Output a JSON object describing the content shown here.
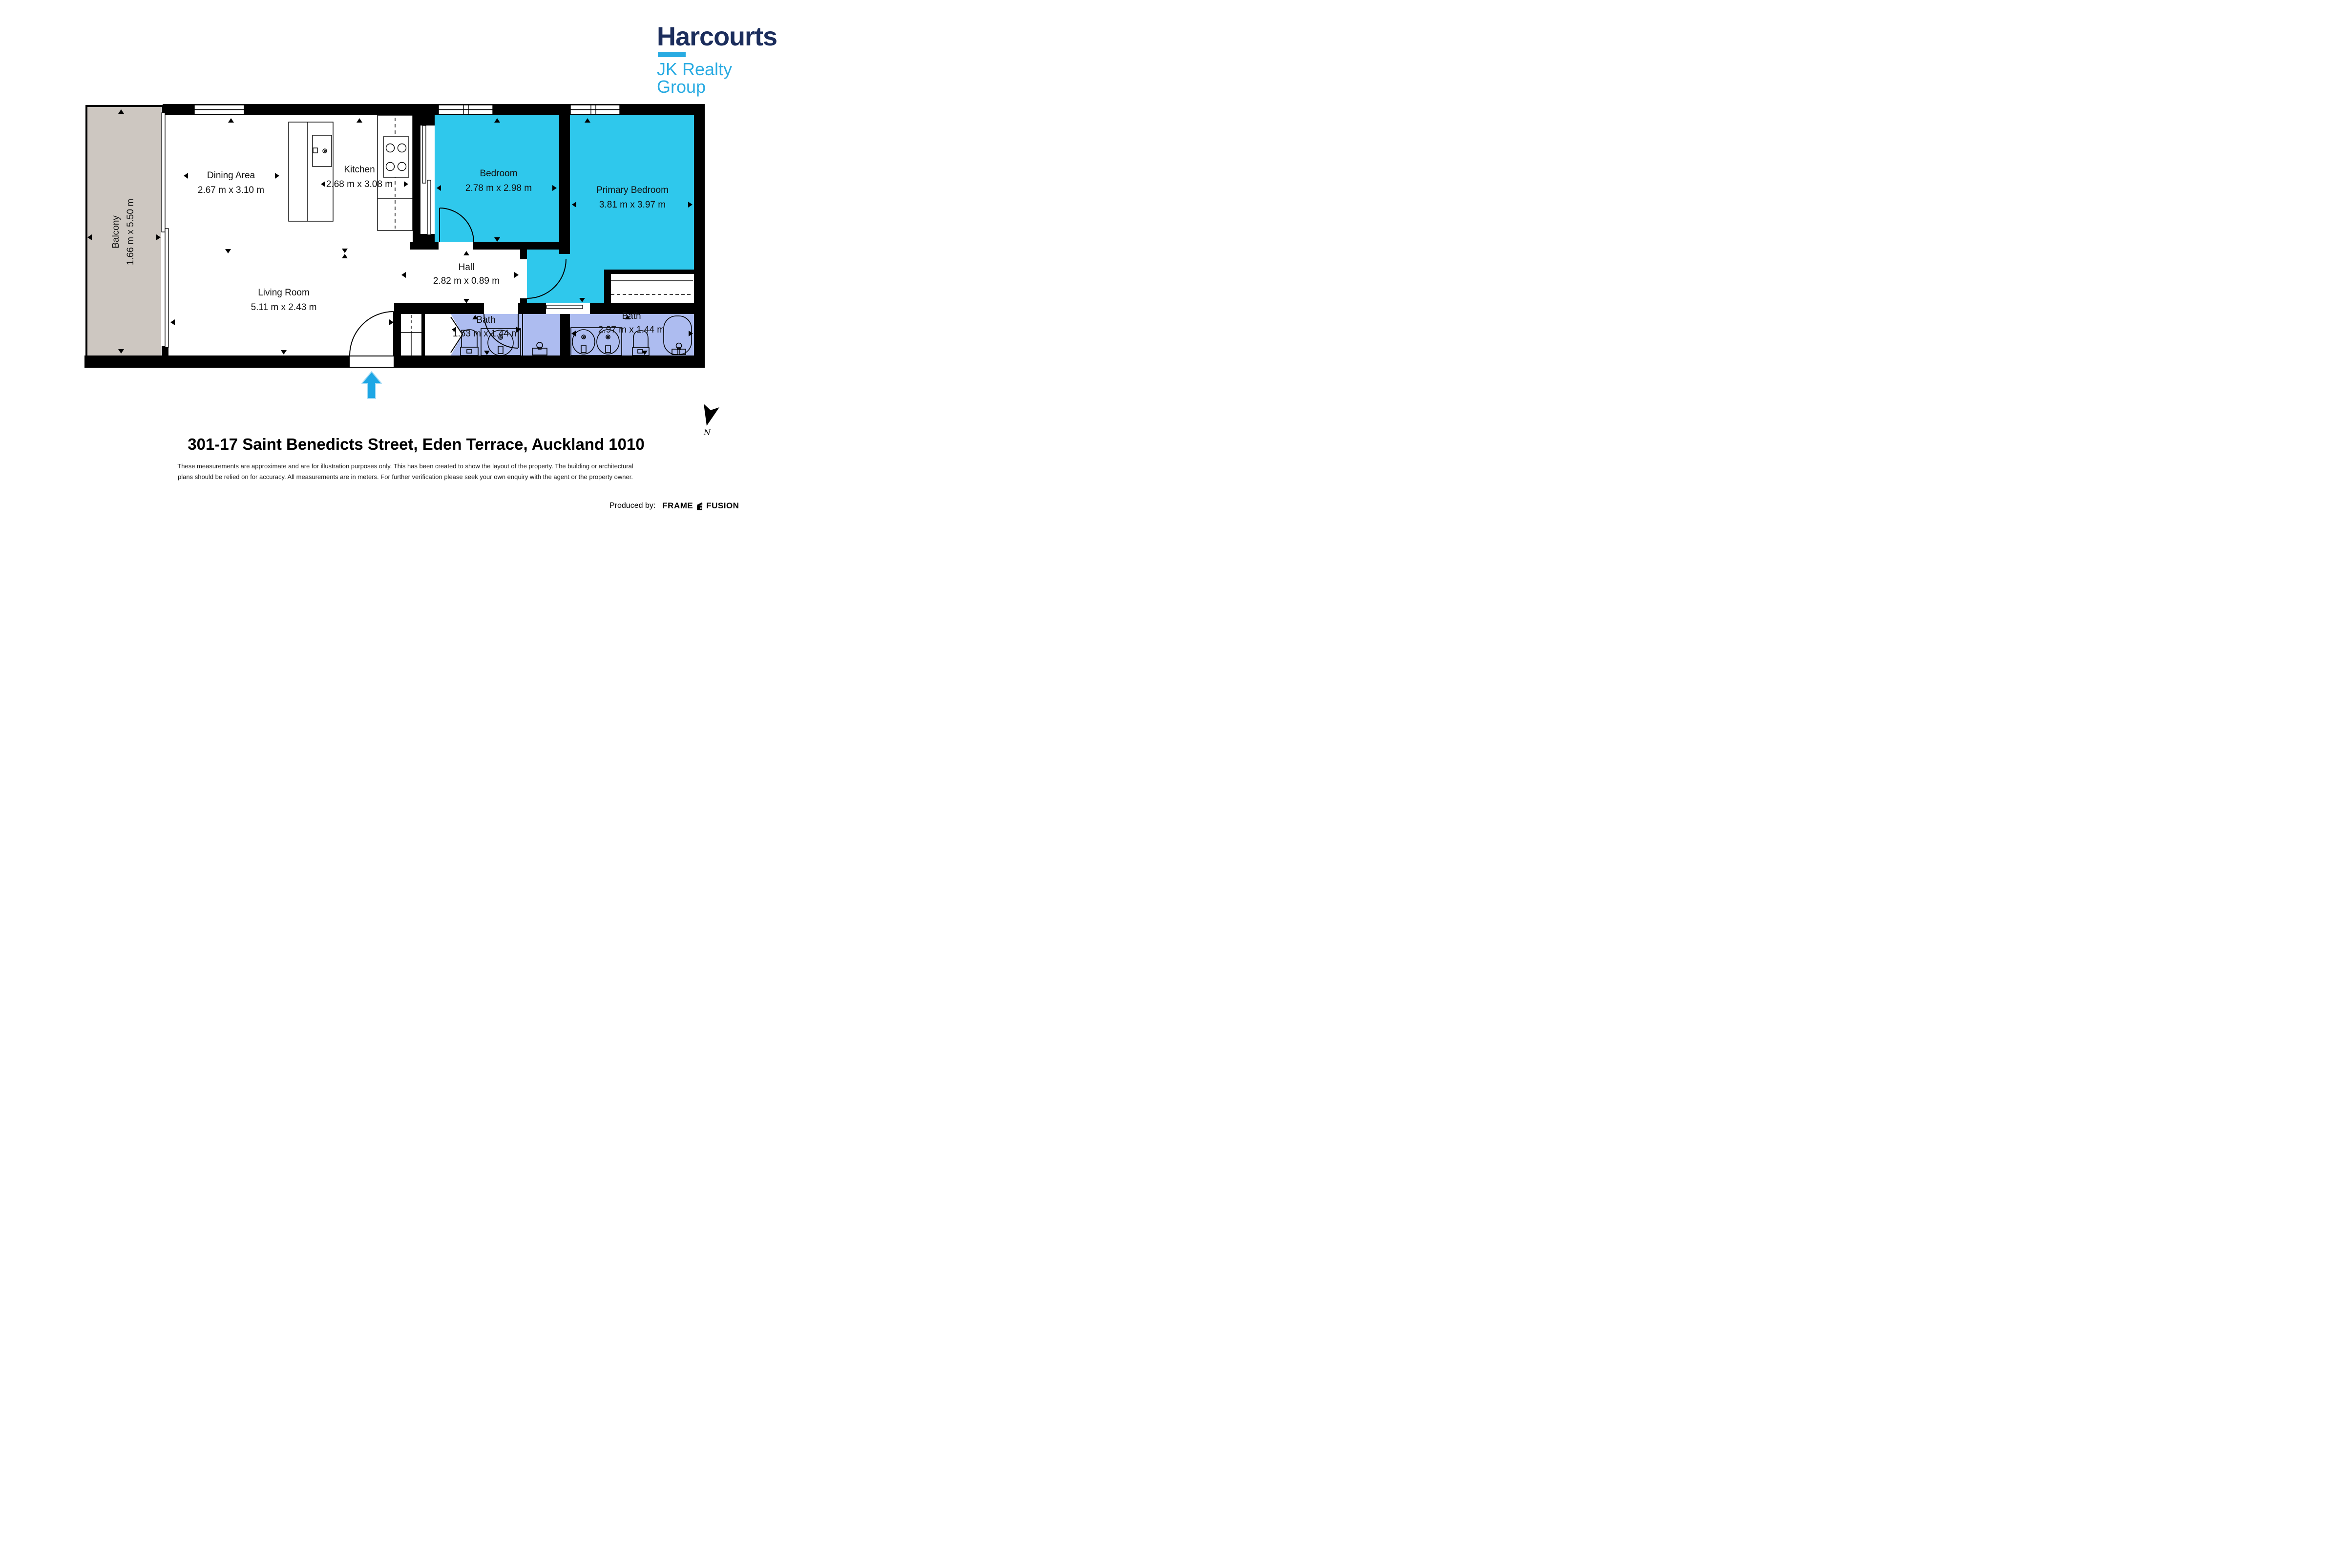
{
  "brand": {
    "name": "Harcourts",
    "group": "JK Realty Group",
    "navy": "#1b2d5c",
    "blue": "#29abe2"
  },
  "plan": {
    "rooms": [
      {
        "id": "balcony",
        "label": "Balcony",
        "dims": "1.66 m x 5.50 m",
        "fill": "#cdc7c1"
      },
      {
        "id": "dining-area",
        "label": "Dining Area",
        "dims": "2.67 m x 3.10 m",
        "fill": "#ffffff"
      },
      {
        "id": "kitchen",
        "label": "Kitchen",
        "dims": "2.68 m x 3.08 m",
        "fill": "#ffffff"
      },
      {
        "id": "bedroom",
        "label": "Bedroom",
        "dims": "2.78 m x 2.98 m",
        "fill": "#2fc8ec"
      },
      {
        "id": "primary-bedroom",
        "label": "Primary Bedroom",
        "dims": "3.81 m x 3.97 m",
        "fill": "#2fc8ec"
      },
      {
        "id": "hall",
        "label": "Hall",
        "dims": "2.82 m x 0.89 m",
        "fill": "#ffffff"
      },
      {
        "id": "living-room",
        "label": "Living Room",
        "dims": "5.11 m x 2.43 m",
        "fill": "#ffffff"
      },
      {
        "id": "bath-1",
        "label": "Bath",
        "dims": "1.53 m x 1.44 m",
        "fill": "#adbcf0"
      },
      {
        "id": "bath-2",
        "label": "Bath",
        "dims": "2.97 m x 1.44 m",
        "fill": "#adbcf0"
      }
    ],
    "north_label": "N",
    "colors": {
      "bedroom_cyan": "#2fc8ec",
      "bath_lavender": "#adbcf0",
      "balcony_gray": "#cdc7c1",
      "wall_black": "#000000",
      "entrance_arrow_blue": "#1ea7e5"
    }
  },
  "footer": {
    "address": "301-17 Saint Benedicts Street, Eden Terrace, Auckland 1010",
    "disclaimer_line1": "These measurements are approximate and are for illustration purposes only. This has been created to show the layout of the property. The building or architectural",
    "disclaimer_line2": "plans should be relied on for accuracy. All measurements are in meters. For further verification please seek your own enquiry with the agent or the property owner.",
    "produced_by_label": "Produced by:",
    "producer_word1": "FRAME",
    "producer_word2": "FUSION"
  }
}
